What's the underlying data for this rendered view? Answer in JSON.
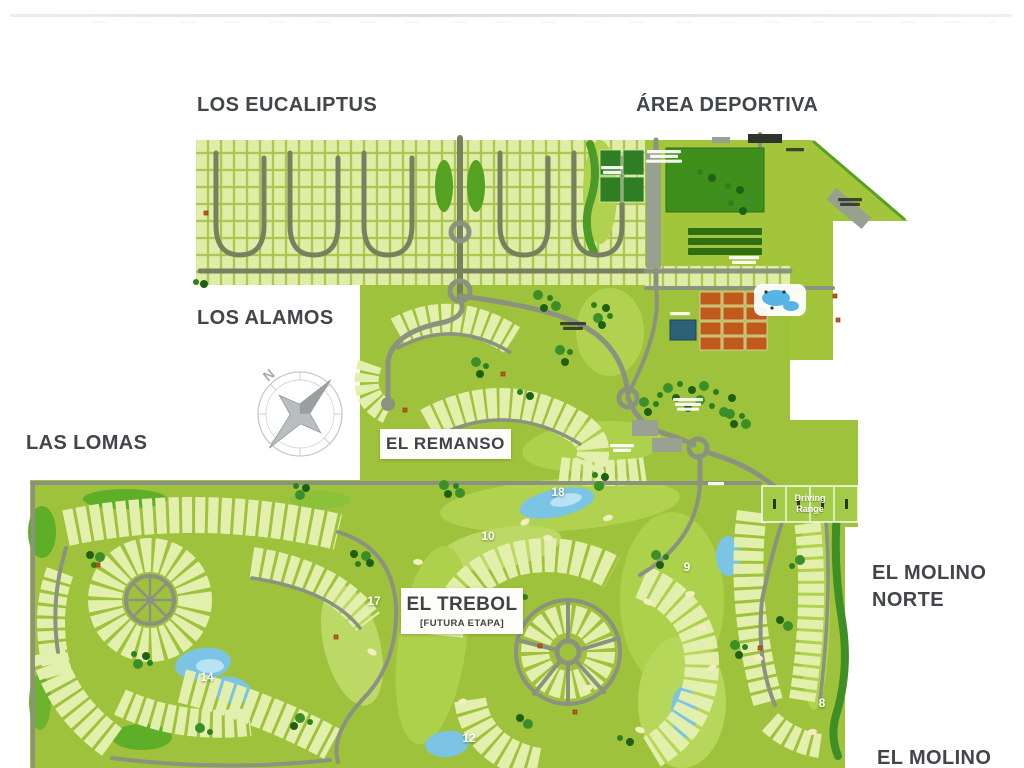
{
  "page": {
    "background": "#ffffff",
    "top_divider_color": "#e6e6e6"
  },
  "map": {
    "area_labels": {
      "los_eucaliptus": "LOS EUCALIPTUS",
      "area_deportiva": "ÁREA DEPORTIVA",
      "los_alamos": "LOS ALAMOS",
      "las_lomas": "LAS LOMAS",
      "el_molino_norte_line1": "EL MOLINO",
      "el_molino_norte_line2": "NORTE",
      "el_molino": "EL MOLINO"
    },
    "boxed_labels": {
      "el_remanso": "EL REMANSO",
      "el_trebol": "EL TREBOL",
      "el_trebol_sub": "[FUTURA ETAPA]"
    },
    "driving_range": {
      "line1": "Driving",
      "line2": "Range"
    },
    "compass": {
      "letter": "N"
    },
    "golf_holes": [
      {
        "number": "18",
        "x": 558,
        "y": 492
      },
      {
        "number": "10",
        "x": 488,
        "y": 536
      },
      {
        "number": "9",
        "x": 687,
        "y": 567
      },
      {
        "number": "17",
        "x": 374,
        "y": 601
      },
      {
        "number": "14",
        "x": 207,
        "y": 677
      },
      {
        "number": "12",
        "x": 469,
        "y": 738
      },
      {
        "number": "8",
        "x": 822,
        "y": 703
      }
    ],
    "colors": {
      "base_green": "#9fc23c",
      "lot_fill": "#e3efad",
      "road_gray": "#8b927f",
      "water_blue": "#7cc4e4",
      "tree_dark": "#2c7a1c",
      "label_gray": "#42464a",
      "clay_court_orange": "#c05a1a",
      "sport_court_green": "#2f7e24",
      "label_box_white": "#fdfdfa"
    }
  }
}
